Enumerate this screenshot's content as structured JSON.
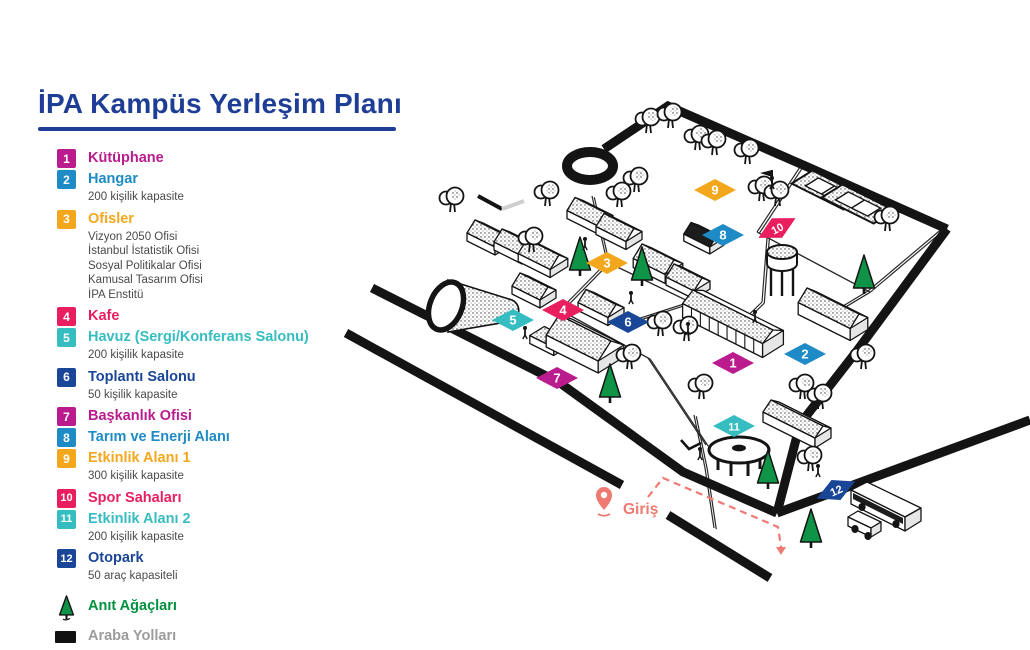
{
  "title": {
    "text": "İPA Kampüs Yerleşim Planı",
    "accent_color": "#1E3D94"
  },
  "legend": {
    "items": [
      {
        "num": "1",
        "label": "Kütüphane",
        "color": "#BA1B8D",
        "sub": []
      },
      {
        "num": "2",
        "label": "Hangar",
        "color": "#1E8BC6",
        "sub": [
          "200 kişilik kapasite"
        ]
      },
      {
        "num": "3",
        "label": "Ofisler",
        "color": "#F3A71D",
        "sub": [
          "Vizyon 2050 Ofisi",
          "İstanbul İstatistik Ofisi",
          "Sosyal Politikalar Ofisi",
          "Kamusal Tasarım Ofisi",
          "İPA Enstitü"
        ]
      },
      {
        "num": "4",
        "label": "Kafe",
        "color": "#E81E5E",
        "sub": []
      },
      {
        "num": "5",
        "label": "Havuz (Sergi/Konferans Salonu)",
        "color": "#36BDC1",
        "sub": [
          "200 kişilik kapasite"
        ]
      },
      {
        "num": "6",
        "label": "Toplantı Salonu",
        "color": "#1A4697",
        "sub": [
          "50 kişilik kapasite"
        ]
      },
      {
        "num": "7",
        "label": "Başkanlık Ofisi",
        "color": "#BA1B8D",
        "sub": []
      },
      {
        "num": "8",
        "label": "Tarım ve Enerji Alanı",
        "color": "#1E8BC6",
        "sub": []
      },
      {
        "num": "9",
        "label": "Etkinlik Alanı 1",
        "color": "#F3A71D",
        "sub": [
          "300 kişilik kapasite"
        ]
      },
      {
        "num": "10",
        "label": "Spor Sahaları",
        "color": "#E81E5E",
        "sub": []
      },
      {
        "num": "11",
        "label": "Etkinlik Alanı 2",
        "color": "#36BDC1",
        "sub": [
          "200 kişilik kapasite"
        ]
      },
      {
        "num": "12",
        "label": "Otopark",
        "color": "#1A4697",
        "sub": [
          "50 araç kapasiteli"
        ]
      }
    ],
    "extras": [
      {
        "icon": "tree",
        "label": "Anıt Ağaçları",
        "color": "#00913F"
      },
      {
        "icon": "road",
        "label": "Araba Yolları",
        "color": "#9B9B9B"
      }
    ]
  },
  "map": {
    "ink": "#141414",
    "tree_green": "#0E9347",
    "entrance": {
      "label": "Giriş",
      "color": "#EF7A72",
      "pin": [
        604,
        508
      ],
      "text_pos": [
        623,
        514
      ],
      "dashed_path": [
        [
          648,
          497
        ],
        [
          663,
          478
        ],
        [
          778,
          527
        ],
        [
          781,
          547
        ]
      ]
    },
    "markers": [
      {
        "n": "1",
        "x": 733,
        "y": 363
      },
      {
        "n": "2",
        "x": 805,
        "y": 354
      },
      {
        "n": "3",
        "x": 607,
        "y": 263
      },
      {
        "n": "4",
        "x": 563,
        "y": 310
      },
      {
        "n": "5",
        "x": 513,
        "y": 320
      },
      {
        "n": "6",
        "x": 628,
        "y": 322
      },
      {
        "n": "7",
        "x": 557,
        "y": 378
      },
      {
        "n": "8",
        "x": 723,
        "y": 235
      },
      {
        "n": "9",
        "x": 715,
        "y": 190
      },
      {
        "n": "10",
        "x": 777,
        "y": 228,
        "rot": -28
      },
      {
        "n": "11",
        "x": 734,
        "y": 426
      },
      {
        "n": "12",
        "x": 836,
        "y": 490,
        "rot": -24
      }
    ],
    "thick_roads": [
      [
        [
          604,
          149
        ],
        [
          668,
          106
        ],
        [
          810,
          168
        ],
        [
          947,
          229
        ]
      ],
      [
        [
          947,
          229
        ],
        [
          856,
          352
        ],
        [
          800,
          424
        ],
        [
          777,
          513
        ]
      ],
      [
        [
          372,
          288
        ],
        [
          560,
          383
        ],
        [
          683,
          472
        ],
        [
          777,
          513
        ]
      ],
      [
        [
          346,
          333
        ],
        [
          622,
          485
        ]
      ],
      [
        [
          668,
          515
        ],
        [
          770,
          578
        ]
      ],
      [
        [
          777,
          513
        ],
        [
          1030,
          420
        ]
      ]
    ],
    "culdesac": {
      "cx": 590,
      "cy": 166,
      "rx": 23,
      "ry": 14
    },
    "road_stub": {
      "black": [
        [
          478,
          196
        ],
        [
          502,
          209
        ]
      ],
      "gray": [
        [
          502,
          209
        ],
        [
          524,
          201
        ]
      ]
    },
    "thin_paths": [
      [
        [
          592,
          196
        ],
        [
          607,
          262
        ]
      ],
      [
        [
          607,
          262
        ],
        [
          560,
          310
        ]
      ],
      [
        [
          607,
          262
        ],
        [
          690,
          302
        ]
      ],
      [
        [
          560,
          310
        ],
        [
          648,
          358
        ]
      ],
      [
        [
          628,
          322
        ],
        [
          690,
          302
        ]
      ],
      [
        [
          690,
          302
        ],
        [
          733,
          330
        ]
      ],
      [
        [
          648,
          358
        ],
        [
          706,
          445
        ]
      ],
      [
        [
          733,
          330
        ],
        [
          762,
          302
        ]
      ],
      [
        [
          762,
          302
        ],
        [
          767,
          238
        ]
      ],
      [
        [
          868,
          291
        ],
        [
          833,
          312
        ]
      ],
      [
        [
          694,
          415
        ],
        [
          705,
          468
        ],
        [
          714,
          528
        ]
      ],
      [
        [
          757,
          232
        ],
        [
          800,
          167
        ],
        [
          944,
          227
        ],
        [
          868,
          291
        ],
        [
          757,
          232
        ]
      ]
    ],
    "buildings": [
      {
        "x": 489,
        "y": 243,
        "a": 14,
        "b": 10,
        "h": 8,
        "r": 8
      },
      {
        "x": 516,
        "y": 252,
        "a": 14,
        "b": 10,
        "h": 8,
        "r": 8
      },
      {
        "x": 543,
        "y": 264,
        "a": 16,
        "b": 11,
        "h": 8,
        "r": 9
      },
      {
        "x": 590,
        "y": 221,
        "a": 15,
        "b": 10,
        "h": 8,
        "r": 8
      },
      {
        "x": 619,
        "y": 237,
        "a": 15,
        "b": 10,
        "h": 8,
        "r": 8
      },
      {
        "x": 658,
        "y": 270,
        "a": 16,
        "b": 11,
        "h": 9,
        "r": 9
      },
      {
        "x": 688,
        "y": 287,
        "a": 14,
        "b": 10,
        "h": 8,
        "r": 8
      },
      {
        "x": 704,
        "y": 243,
        "a": 13,
        "b": 9,
        "h": 7,
        "r": 7,
        "dark": true
      },
      {
        "x": 534,
        "y": 296,
        "a": 14,
        "b": 10,
        "h": 8,
        "r": 8
      },
      {
        "x": 601,
        "y": 313,
        "a": 15,
        "b": 10,
        "h": 8,
        "r": 8
      },
      {
        "x": 585,
        "y": 352,
        "a": 26,
        "b": 16,
        "h": 12,
        "r": 12
      },
      {
        "x": 549,
        "y": 345,
        "a": 12,
        "b": 9,
        "h": 8,
        "r": 0
      },
      {
        "x": 733,
        "y": 331,
        "a": 40,
        "b": 13,
        "h": 14,
        "r": 7,
        "stripes": true
      },
      {
        "x": 833,
        "y": 322,
        "a": 26,
        "b": 11,
        "h": 12,
        "r": 9
      },
      {
        "x": 797,
        "y": 430,
        "a": 26,
        "b": 10,
        "h": 10,
        "r": 7
      }
    ],
    "hangar": {
      "body": "M448,280 L512,300 C521,304 521,317 512,321 L448,332 Z",
      "cap": {
        "cx": 446,
        "cy": 306,
        "rx": 16,
        "ry": 25,
        "rot": 22
      }
    },
    "courts": {
      "centers": [
        [
          828,
          190
        ],
        [
          858,
          204
        ]
      ],
      "a": 26,
      "b": 13
    },
    "flag": [
      772,
      170
    ],
    "tower": [
      782,
      268
    ],
    "table": [
      739,
      450
    ],
    "bench": [
      [
        681,
        440
      ],
      [
        689,
        449
      ],
      [
        701,
        443
      ]
    ],
    "green_trees": [
      [
        580,
        270
      ],
      [
        642,
        280
      ],
      [
        610,
        397
      ],
      [
        864,
        288
      ],
      [
        768,
        483
      ],
      [
        811,
        542
      ]
    ],
    "round_trees": [
      [
        648,
        133
      ],
      [
        670,
        128
      ],
      [
        697,
        150
      ],
      [
        714,
        155
      ],
      [
        747,
        164
      ],
      [
        636,
        192
      ],
      [
        619,
        207
      ],
      [
        547,
        206
      ],
      [
        452,
        212
      ],
      [
        531,
        252
      ],
      [
        660,
        336
      ],
      [
        686,
        341
      ],
      [
        629,
        369
      ],
      [
        701,
        399
      ],
      [
        761,
        201
      ],
      [
        777,
        206
      ],
      [
        887,
        231
      ],
      [
        802,
        399
      ],
      [
        820,
        409
      ],
      [
        810,
        471
      ],
      [
        863,
        369
      ]
    ],
    "people": [
      [
        585,
        247
      ],
      [
        525,
        336
      ],
      [
        631,
        301
      ],
      [
        688,
        332
      ],
      [
        772,
        186
      ],
      [
        818,
        474
      ],
      [
        755,
        320
      ],
      [
        700,
        457
      ]
    ],
    "bus": {
      "roof": [
        [
          851,
          490
        ],
        [
          905,
          517
        ],
        [
          921,
          508
        ],
        [
          867,
          482
        ]
      ],
      "side": [
        [
          851,
          490
        ],
        [
          905,
          517
        ],
        [
          905,
          531
        ],
        [
          851,
          504
        ]
      ],
      "windows": [
        [
          853,
          493
        ],
        [
          903,
          518
        ],
        [
          903,
          524
        ],
        [
          853,
          499
        ]
      ],
      "front": [
        [
          905,
          517
        ],
        [
          921,
          508
        ],
        [
          921,
          521
        ],
        [
          905,
          531
        ]
      ],
      "wheels": [
        [
          862,
          507
        ],
        [
          896,
          524
        ]
      ]
    },
    "car": {
      "roof": [
        [
          848,
          517
        ],
        [
          871,
          528
        ],
        [
          881,
          522
        ],
        [
          858,
          511
        ]
      ],
      "side": [
        [
          848,
          517
        ],
        [
          871,
          528
        ],
        [
          871,
          537
        ],
        [
          848,
          526
        ]
      ],
      "front": [
        [
          871,
          528
        ],
        [
          881,
          522
        ],
        [
          881,
          531
        ],
        [
          871,
          537
        ]
      ],
      "wheels": [
        [
          855,
          529
        ],
        [
          868,
          536
        ]
      ]
    }
  }
}
